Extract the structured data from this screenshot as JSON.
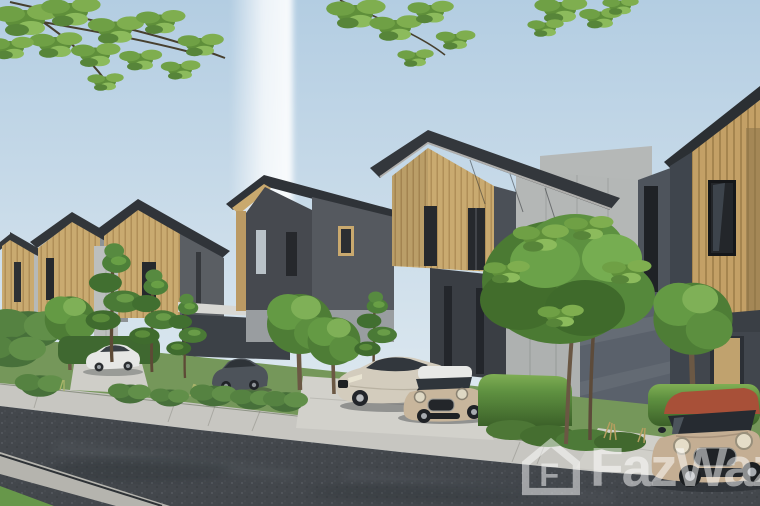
{
  "meta": {
    "type": "architectural-rendering",
    "subject": "Street view 3D rendering of a modern two-storey townhouse development with landscaped gardens and parked cars"
  },
  "watermark": {
    "label": "FazWaz",
    "logo_letter": "F",
    "icon": "fazwaz-house-logo-icon",
    "style": "semi-transparent white",
    "opacity": 0.5,
    "position": "bottom-right"
  },
  "scene": {
    "sky": {
      "description": "clear pale blue sky with a soft white vertical light streak left of centre",
      "top_color": "#b3cde2",
      "bottom_color": "#e8eff4"
    },
    "buildings": {
      "name": "townhouse-row",
      "count": 6,
      "style": "gabled charcoal metal roofs, vertical timber-slat gable facades, light grey fibre-cement panel volumes, dark blue-grey ground walls, tall narrow black windows",
      "roof_color": "#2f3338",
      "timber_color": "#c9aa70",
      "panel_light_color": "#b4b7b6",
      "panel_mid_color": "#8e9295",
      "wall_dark_color": "#5a616b",
      "door_color": "#c0a26e"
    },
    "vehicles": [
      {
        "name": "white-sedan",
        "color": "#e6e7e5",
        "location": "far-left driveway"
      },
      {
        "name": "dark-grey-hatchback",
        "color": "#4d535a",
        "location": "left driveway behind shrubs"
      },
      {
        "name": "champagne-sedan",
        "color": "#d3ccbd",
        "location": "centre driveway"
      },
      {
        "name": "beige-mini-white-roof",
        "color": "#c8b69c",
        "roof_color": "#e8e9e7",
        "location": "centre driveway"
      },
      {
        "name": "beige-mini-red-roof",
        "color": "#c4ae93",
        "roof_color": "#a85038",
        "location": "right driveway, partially out of frame"
      }
    ],
    "vegetation": {
      "overhanging_branches": "green leafy branches along the top edge (left, centre, right)",
      "garden": "clipped hedges, layered pine topiary, round ornamental trees, ground-cover beds and grasses along the frontages",
      "feature_tree": "large leafy tree in front of the centre-right unit"
    },
    "street": {
      "description": "dark asphalt street in the foreground with concrete footpath, private driveways, gutter strip and grass verge",
      "road_color": "#43474c",
      "sidewalk_color": "#c7c6c1",
      "driveway_color": "#d2d1cb"
    }
  },
  "palette": {
    "sky": "#c4d7e6",
    "roof": "#2f3338",
    "timber": "#c9aa70",
    "panel": "#b4b7b6",
    "foliage": "#4e7d36",
    "asphalt": "#43474c",
    "concrete": "#c7c6c1",
    "watermark": "#ffffff"
  }
}
